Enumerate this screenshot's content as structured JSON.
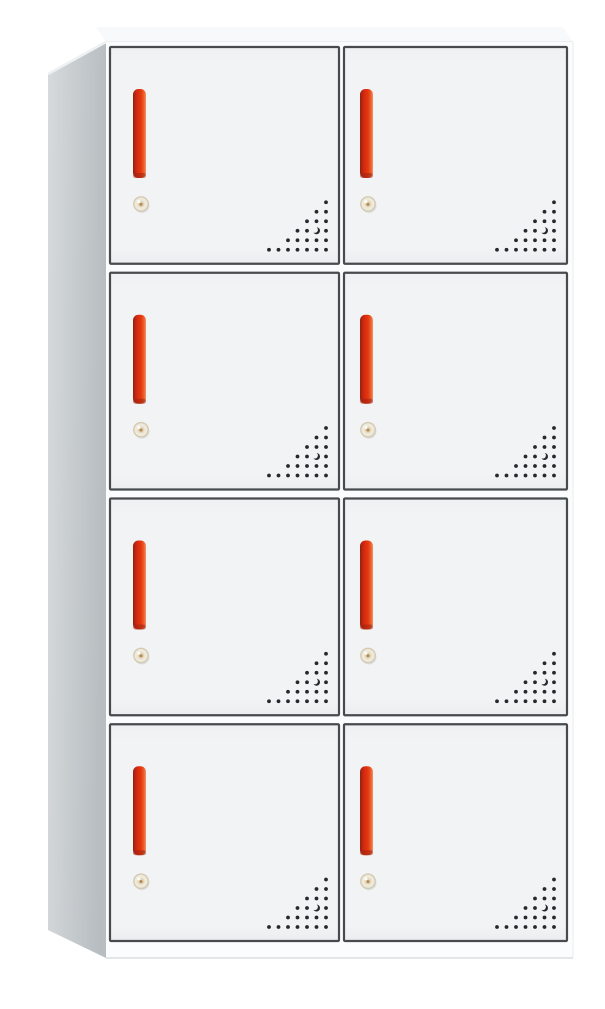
{
  "scene": {
    "background_color": "#ffffff",
    "subject": "eight-door metal locker cabinet with red vertical handles, round key locks and corner ventilation holes"
  },
  "cabinet": {
    "rows": 4,
    "columns": 2,
    "door_count": 8,
    "doors": [
      {
        "id": "door-1",
        "row": 1,
        "column": 1
      },
      {
        "id": "door-2",
        "row": 1,
        "column": 2
      },
      {
        "id": "door-3",
        "row": 2,
        "column": 1
      },
      {
        "id": "door-4",
        "row": 2,
        "column": 2
      },
      {
        "id": "door-5",
        "row": 3,
        "column": 1
      },
      {
        "id": "door-6",
        "row": 3,
        "column": 2
      },
      {
        "id": "door-7",
        "row": 4,
        "column": 1
      },
      {
        "id": "door-8",
        "row": 4,
        "column": 2
      }
    ],
    "vent_pattern": [
      "......o",
      ".....oo",
      "....ooo",
      "...ooco",
      "..ooooo",
      "ooooooo"
    ],
    "colors": {
      "frame": "#fbfcfd",
      "frame_edge": "#dadddf",
      "side_panel_light": "#d6dadc",
      "side_panel_dark": "#b7bdc1",
      "side_panel_highlight": "#eef1f2",
      "top_surface": "#f7f9fa",
      "top_surface_edge": "#e4e7e9",
      "door_face": "#f2f3f5",
      "door_face_top": "#eef0f2",
      "door_face_bottom": "#ecedef",
      "door_border": "#474b4e",
      "handle_dark": "#8f2012",
      "handle_mid": "#da2c0f",
      "handle_bright": "#e5380f",
      "handle_orange": "#ed5f2a",
      "handle_light": "#f2926a",
      "lock_ring": "#d3cab2",
      "lock_face": "#efe9da",
      "lock_inner": "#e0d6bd",
      "lock_core": "#b98a52",
      "vent_dot": "#26292b"
    }
  }
}
